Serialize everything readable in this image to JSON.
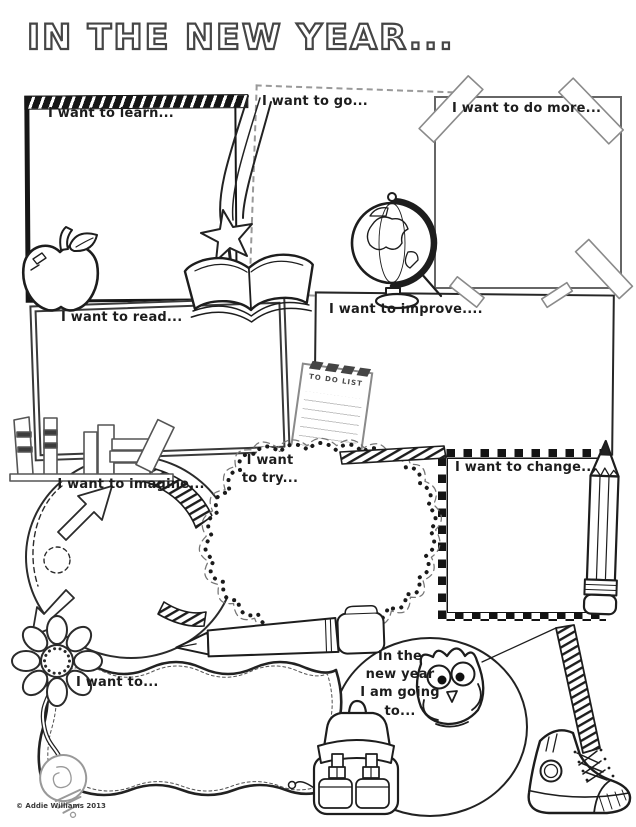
{
  "page": {
    "title": "IN THE NEW YEAR...",
    "copyright": "© Addie Williams 2013",
    "paper": "#ffffff",
    "ink": "#1d1d1d",
    "tape_gray": "#8a8a8a",
    "light_gray": "#999999"
  },
  "prompts": {
    "learn": "I want to learn...",
    "go": "I want to go...",
    "do_more": "I want to do more...",
    "read": "I want to read...",
    "improve": "I want to improve....",
    "imagine": "I want to imagine...",
    "try": "I want\nto try...",
    "change": "I want to change...",
    "want": "I want to...",
    "new_year": "In the\nnew year\nI am going\nto..."
  },
  "todo_note": {
    "header": "TO DO LIST"
  },
  "decorations": [
    "shooting-star",
    "open-book",
    "globe",
    "apple",
    "washi-tape",
    "to-do-list-note",
    "bookshelf",
    "arrow-doodles",
    "dotted-cloud",
    "pencil",
    "fountain-pen",
    "flower",
    "lightbulb",
    "owl",
    "backpack",
    "high-top-sneaker",
    "striped-ribbon"
  ]
}
